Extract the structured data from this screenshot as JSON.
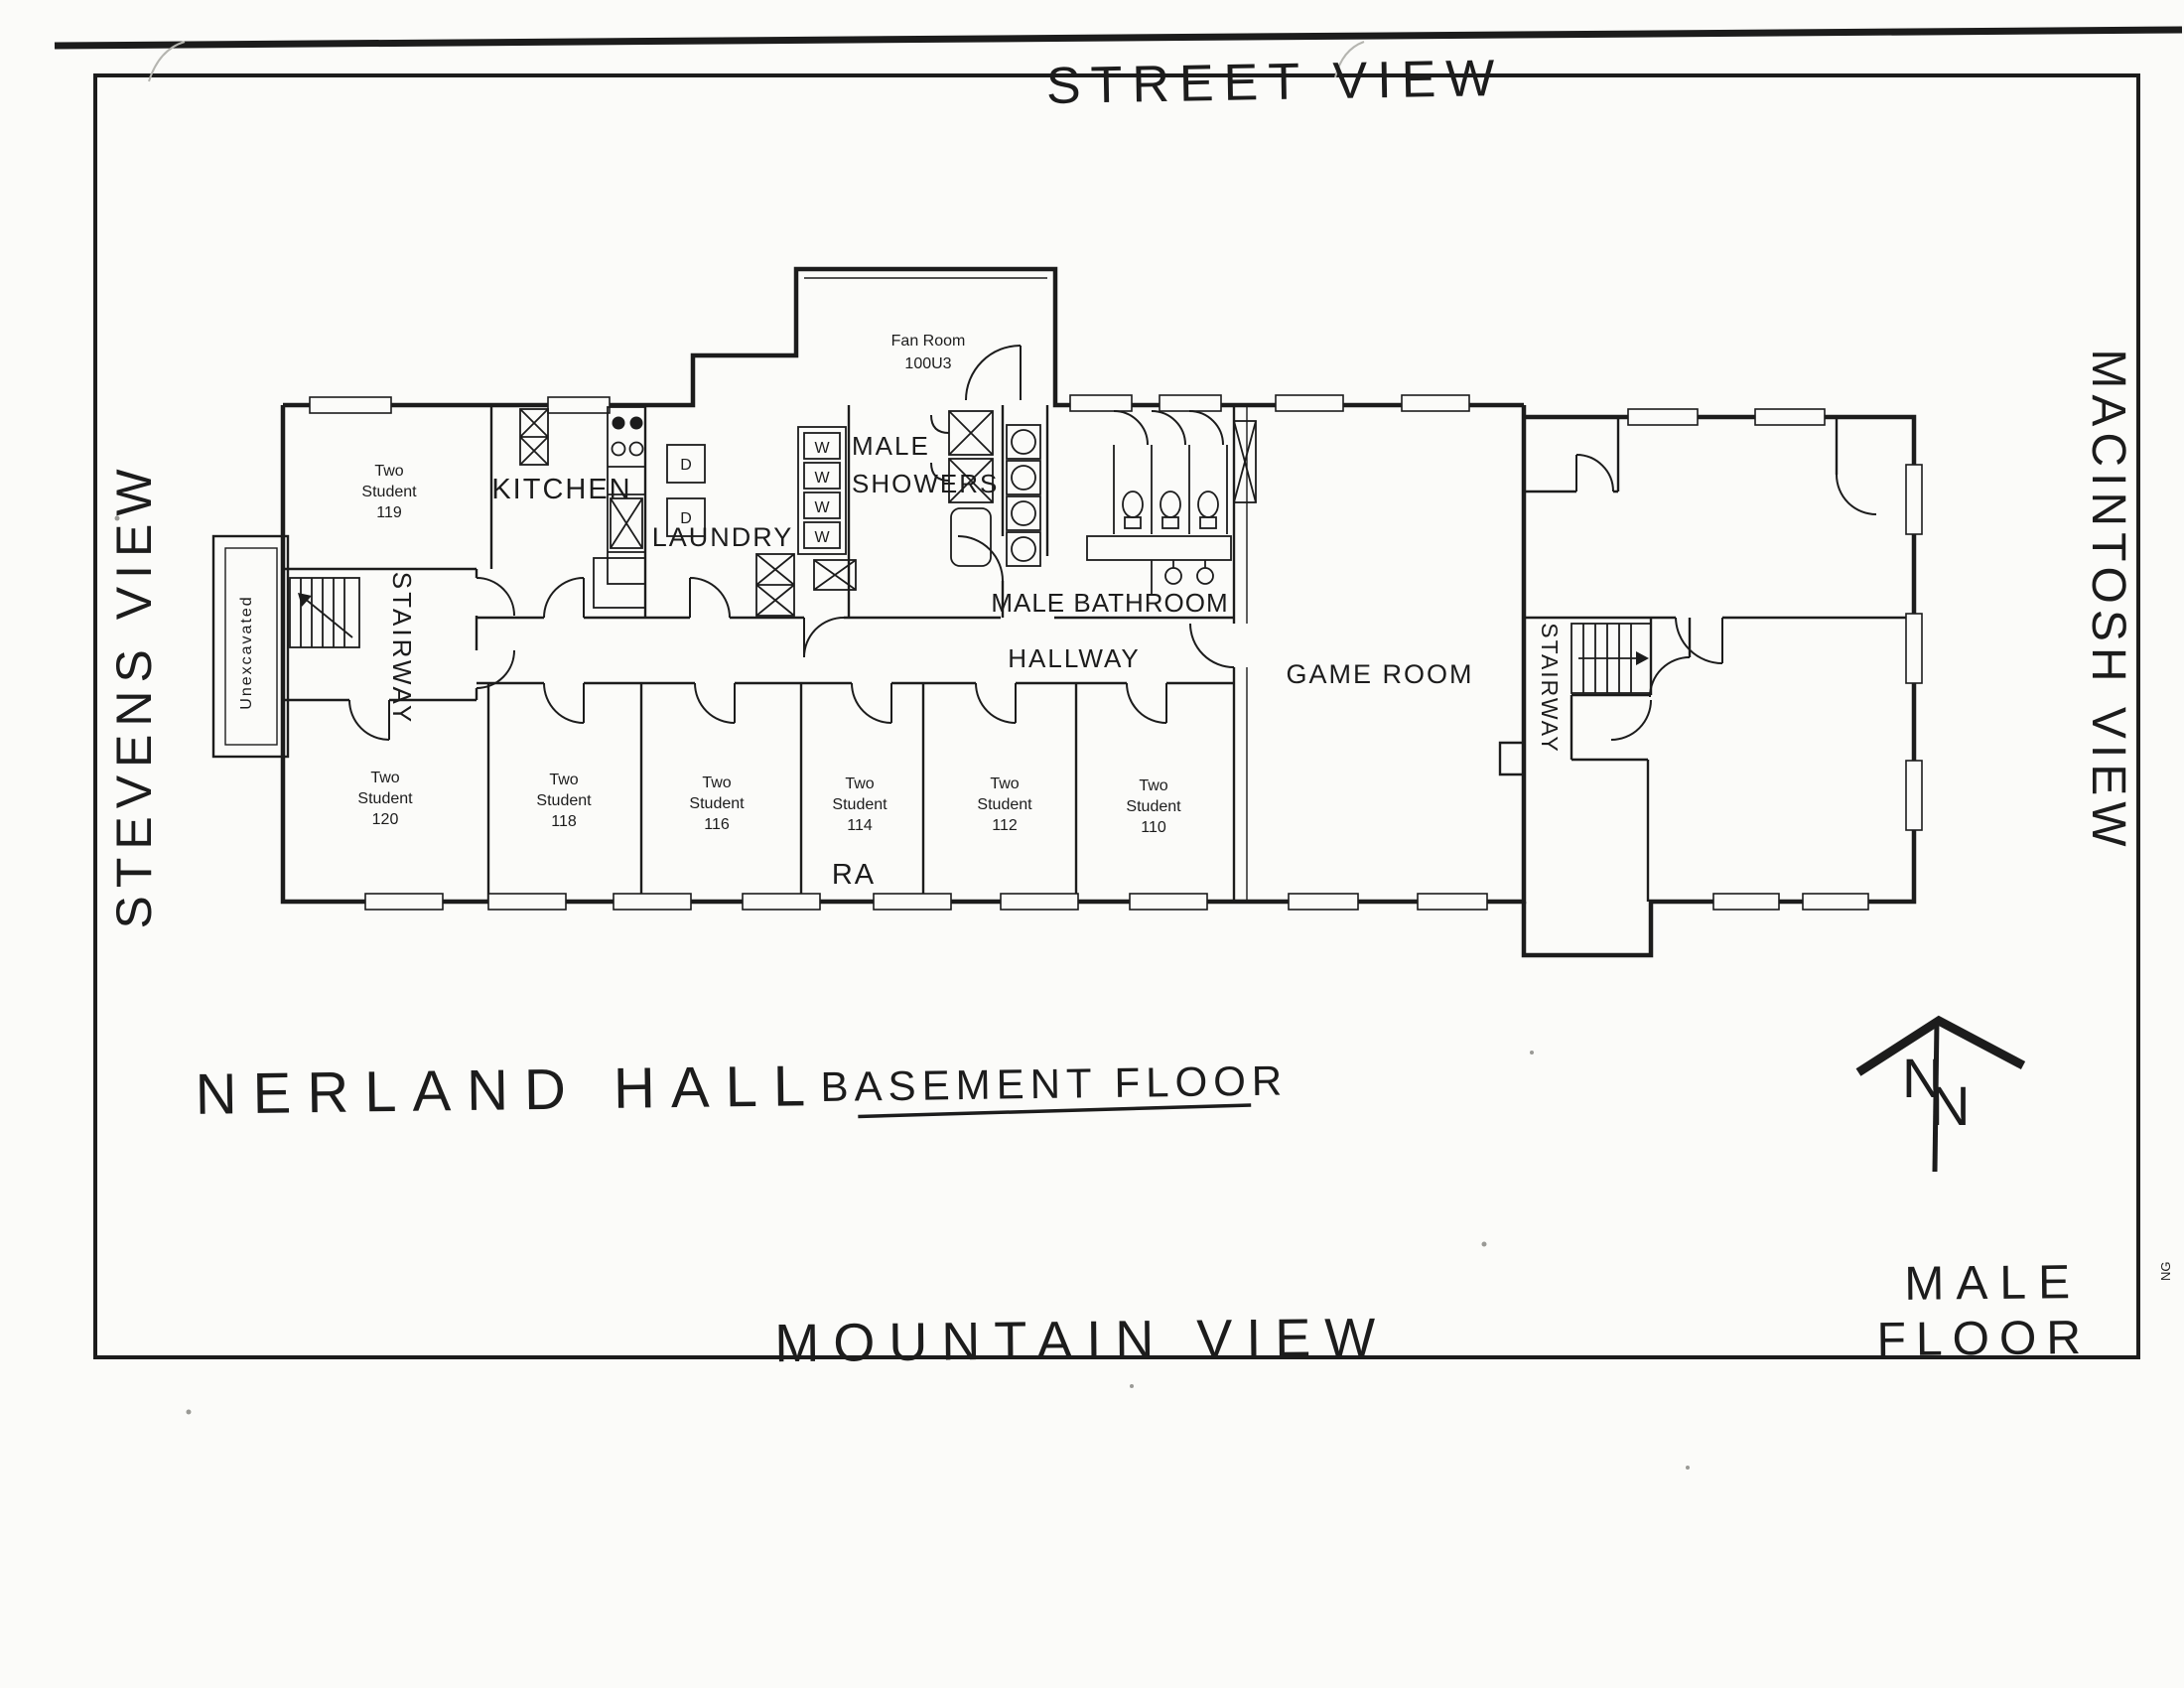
{
  "document": {
    "building": "NERLAND HALL",
    "floor_title": "BASEMENT FLOOR",
    "orientation_labels": {
      "top": "STREET VIEW",
      "left": "STEVENS VIEW",
      "right": "MACINTOSH VIEW",
      "bottom": "MOUNTAIN VIEW"
    },
    "floor_type": {
      "line1": "MALE",
      "line2": "FLOOR"
    },
    "north_arrow": {
      "letter": "N"
    },
    "edge_mark": "NG"
  },
  "rooms": {
    "fan_room": {
      "line1": "Fan Room",
      "line2": "100U3"
    },
    "kitchen": "KITCHEN",
    "laundry": "LAUNDRY",
    "male_showers": {
      "line1": "MALE",
      "line2": "SHOWERS"
    },
    "male_bathroom": "MALE BATHROOM",
    "hallway": "HALLWAY",
    "game_room": "GAME ROOM",
    "stairway_west": "STAIRWAY",
    "stairway_east": "STAIRWAY",
    "unexcavated": "Unexcavated",
    "ra": "RA",
    "student_119": {
      "line1": "Two",
      "line2": "Student",
      "line3": "119"
    },
    "student_120": {
      "line1": "Two",
      "line2": "Student",
      "line3": "120"
    },
    "student_118": {
      "line1": "Two",
      "line2": "Student",
      "line3": "118"
    },
    "student_116": {
      "line1": "Two",
      "line2": "Student",
      "line3": "116"
    },
    "student_114": {
      "line1": "Two",
      "line2": "Student",
      "line3": "114"
    },
    "student_112": {
      "line1": "Two",
      "line2": "Student",
      "line3": "112"
    },
    "student_110": {
      "line1": "Two",
      "line2": "Student",
      "line3": "110"
    }
  },
  "fixtures": {
    "washer_label": "W",
    "dryer_label": "D",
    "washer_count": 4,
    "dryer_count": 2
  }
}
